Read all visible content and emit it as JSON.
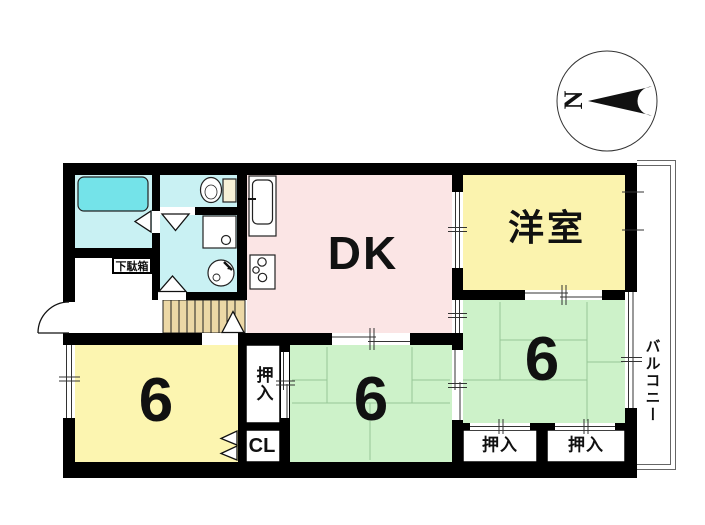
{
  "compass": {
    "north_label": "N"
  },
  "rooms": {
    "dk": {
      "label": "DK",
      "color": "#fbe5e5"
    },
    "western_room": {
      "label": "洋室",
      "color": "#fbf3ae"
    },
    "tatami_left": {
      "label": "6",
      "color": "#fcf5b0"
    },
    "tatami_middle": {
      "label": "6",
      "color": "#cdf2c9"
    },
    "tatami_right": {
      "label": "6",
      "color": "#cdf2c9"
    },
    "bathroom": {
      "color": "#c9f1f3"
    },
    "toilet": {
      "color": "#c9f1f3"
    },
    "washroom": {
      "color": "#c9f1f3"
    },
    "stairs": {
      "color": "#ecd8a6"
    },
    "bathtub": {
      "color": "#74e3e9"
    }
  },
  "closets": {
    "oshiire_middle": {
      "label": "押入",
      "orientation": "vertical"
    },
    "closet_cl": {
      "label": "CL"
    },
    "oshiire_right_1": {
      "label": "押入"
    },
    "oshiire_right_2": {
      "label": "押入"
    },
    "getabako": {
      "label": "下駄箱"
    }
  },
  "balcony": {
    "label": "バルコニー",
    "orientation": "vertical"
  },
  "wall_color": "#000000"
}
